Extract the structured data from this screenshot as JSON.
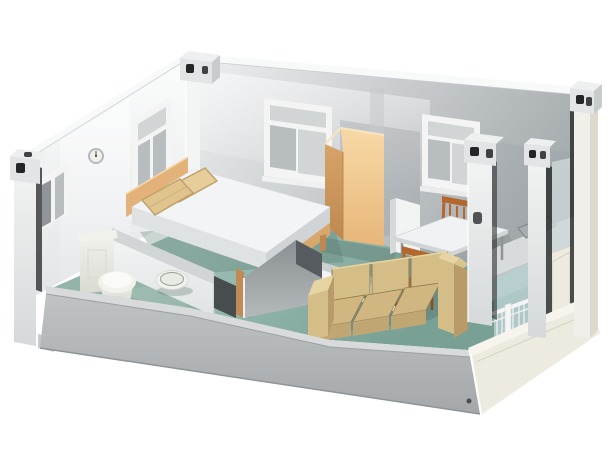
{
  "meta": {
    "width": 611,
    "height": 462,
    "title": "3D cutaway rendering of a one-bedroom prefab container house interior"
  },
  "labels": {
    "scene": "Isometric cutaway view of a prefab container home with bedroom, bathroom, living room, dining area and balcony",
    "building": "Container house shell with white wall panels and corner posts",
    "backLeftWall": "Back-left wall with windows and clock",
    "backRightWall": "Back-right wall with two windows",
    "base": "Gray plinth base of the container",
    "fascia": "Cream balcony fascia and right-side frame",
    "bed": "Double bed with white mattress and wooden headboard",
    "pillows": "Two tan pillows",
    "wardrobe": "Tall light-wood wardrobe cabinet",
    "sofa": "Tan three-seat sofa",
    "table": "White dining table with metal legs",
    "chairBack": "Wooden dining chair behind table",
    "chairFront": "Wooden dining chair in front of table",
    "toilet": "White toilet with tank",
    "basin": "Round floor wash basin",
    "clock": "Round wall clock",
    "windowLeftSmall": "Small double-pane window on left wall",
    "windowLeftLarge": "Tall window with transom on left wall",
    "windowBackA": "Sliding window on back wall (left)",
    "windowBackB": "Sliding window on back wall (right)",
    "counter": "Kitchenette counter with sink",
    "railing": "White balcony railing with glass panels",
    "door": "Open interior door at bathroom entrance",
    "partitions": "Half-height interior partition walls",
    "posts": "Corner posts with container corner fittings",
    "floor": "Teal-green interior floor"
  },
  "colors": {
    "bg": "#ffffff",
    "wallLeftLight": "#fbfcfc",
    "wallLeftShade": "#e2e5e7",
    "wallCap": "#f8f9f9",
    "wallRightLight": "#edeff0",
    "wallRightMid": "#c6cacc",
    "wallRightDark": "#999fa2",
    "postWhite": "#f3f4f4",
    "postShade": "#d6d9da",
    "fittingLight": "#e2e4e5",
    "fittingMid": "#c8cbcc",
    "fittingTop": "#eef0f0",
    "holeDark": "#232526",
    "grooveDark": "#2e3132",
    "baseLip": "#d8dadb",
    "baseFace": "#c0c3c5",
    "baseFaceDark": "#a4a8aa",
    "fasciaCream": "#edeadf",
    "fasciaCreamLight": "#f6f4ec",
    "fasciaCreamShade": "#d9d5c5",
    "floorTealLight": "#9fc0b6",
    "floorTealFront": "#78a095",
    "floorTealDark": "#54746b",
    "glassTeal": "#b6cfd0",
    "glassGray": "#ced8d8",
    "frameWhite": "#f3f4f3",
    "paneDark": "#8f9598",
    "paneMid": "#b8bec0",
    "paneLight": "#d1d5d6",
    "woodLight": "#f8d9a6",
    "woodMid": "#e7b67a",
    "woodSide": "#d8a369",
    "woodDark": "#bd8950",
    "headboardWood": "#e3b27b",
    "pillowTan": "#e0c48e",
    "pillowTan2": "#e6cd9a",
    "pillowShade": "#bfa069",
    "mattressTop": "#f3f4f5",
    "mattressSide": "#dfe2e3",
    "mattressFoot": "#d1d4d6",
    "bedRailWood": "#d8a76b",
    "sofaTan": "#d5bd88",
    "sofaTanLight": "#e6d4a2",
    "sofaTanDark": "#b79c6a",
    "sofaSeat": "#d0b781",
    "sofaSeatFront": "#bfa673",
    "sofaOutline": "#8a7549",
    "sofaCrevice": "#4a3f28",
    "chairWood": "#b4662f",
    "chairWoodDark": "#8d4a20",
    "tableWhite": "#f1f2f3",
    "tableEdge": "#d2d5d6",
    "legGray": "#8f9396",
    "counterTop": "#d8dbdc",
    "counterFace": "#c2c6c7",
    "sinkGray": "#a8adaf",
    "sinkEdge": "#7d8284",
    "ceramic": "#f2f2ed",
    "ceramicShade": "#d9dad2",
    "ceramicLight": "#fafaf8",
    "partGrayTop": "#d2d5d6",
    "partWhite": "#f2f4f4",
    "partWhiteShade": "#dfe3e3",
    "partGray": "#8a9093",
    "partGrayLight": "#b4b9ba",
    "partGrayDark": "#565b5f",
    "doorWood": "#c08b55",
    "doorwayDark": "#474c4f",
    "railWhite": "#f4f5f4"
  }
}
